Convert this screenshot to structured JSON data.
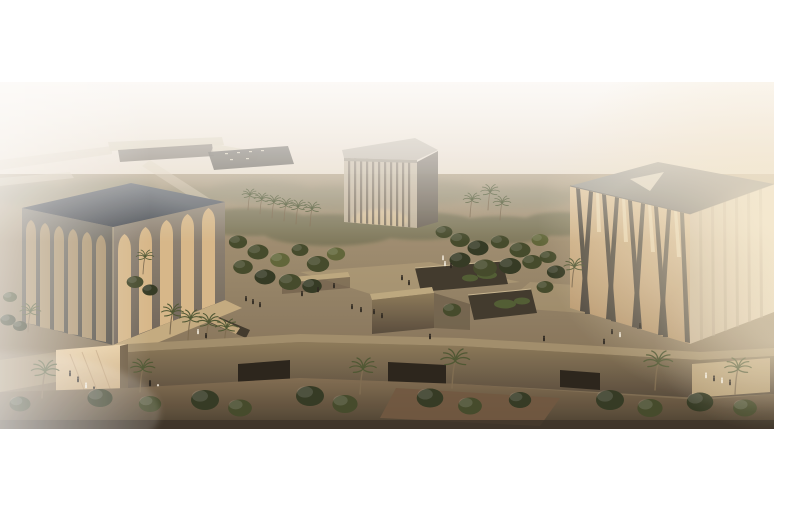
{
  "page": {
    "background_color": "#ffffff"
  },
  "figure": {
    "description": "Aerial architectural rendering at hazy golden hour: three cubic pavilions around a landscaped stone plaza - a left cube with tall pointed-arch openings and a dark flat roof, a smaller center cube of thin vertical columns with a light roof slab, and a right cube of crossing diagonal columns with a triangular skylight on its grey roof - with sunken garden courtyards, palm trees, a perimeter wall with dark doorway openings, small pedestrians, a highway overpass on the hazy horizon and bright sun glare at the upper right",
    "offset": {
      "top_px": 82,
      "left_px": 0,
      "width_px": 774,
      "height_px": 347
    },
    "buildings": [
      {
        "name": "arched-cube-pavilion",
        "position": "left",
        "features": "pointed-arch colonnade on two faces, dark slate flat roof, warm interior glow"
      },
      {
        "name": "vertical-column-cube-pavilion",
        "position": "center-rear",
        "features": "thin vertical column facade, pale flat roof slab, hazy"
      },
      {
        "name": "diagonal-lattice-cube-pavilion",
        "position": "right",
        "features": "crossing diagonal columns, grey roof with pale triangular skylight, backlit warm interior"
      }
    ],
    "environment": [
      "hazy beige sky",
      "highway overpass and parking area on horizon",
      "dense olive-green tree clusters and palm rows",
      "raised plaza with sunken planted courtyards",
      "long perimeter wall with dark doorway openings",
      "scattered pedestrians, some in white robes",
      "shadowed foreground garden strip"
    ],
    "colors": {
      "sky_top": "#efe8dc",
      "sky_mid": "#e2d4c1",
      "sky_low": "#cdbaa3",
      "horizon": "#b9a78d",
      "ground_top": "#ab9a7d",
      "ground_low": "#74634a",
      "fg_top": "#7f6b50",
      "fg_low": "#443a2c",
      "tree_dark": "#3f4628",
      "tree_mid": "#5c6336",
      "tree_deep": "#2e3520",
      "tree_hazy": "#8f8a6f",
      "tree_row2": "#6f7052",
      "palm_frond": "#4a5430",
      "trunk": "#7c6a4f",
      "road_light": "#d6cab2",
      "underpass": "#5f584e",
      "parking": "#4e4a42",
      "dash": "#cfc6ae",
      "mosque_roof_light": "#5d646c",
      "mosque_roof_dark": "#343a42",
      "mosque_face_left_top": "#6e6a60",
      "mosque_face_left_bot": "#4b4840",
      "mosque_face_right_top": "#948a7b",
      "mosque_face_right_bot": "#6b6156",
      "arch_glow": "#d7b88a",
      "arch_glow_shadow": "#a8906a",
      "terrace": "#c3ab80",
      "church_roof": "#b8b0a1",
      "church_roof_edge": "#98907f",
      "church_face": "#c4b7a0",
      "church_stripe": "#7e7363",
      "church_side": "#6f685c",
      "church_glow": "#e0c9a2",
      "syn_roof_light": "#8b8b85",
      "syn_roof_dark": "#4d5055",
      "syn_tri": "#d6cfbe",
      "syn_glow_top": "#d9bd92",
      "syn_glow_bot": "#b3946c",
      "syn_slat": "#4a453c",
      "syn_streak": "#ecdcb6",
      "syn_side_l": "#c3b194",
      "syn_side_r": "#ecdfc4",
      "syn_side_slat": "#a6967e",
      "wall_top": "#a08d6b",
      "wall_face_top": "#8a7858",
      "wall_face_bot": "#54483a",
      "opening": "#241f18",
      "entry_light": "#e8cfa4",
      "entry_dark": "#b59468",
      "pit": "#3b352a",
      "pit_green": "#4c5a31",
      "wall_lit": "#bca87f",
      "shadow": "#5e5140",
      "person_dark": "#26221c",
      "person_white": "#ece6d8",
      "haze": "#ffffff",
      "glare": "#f7ecd4",
      "red_ground": "#6d543e"
    }
  }
}
